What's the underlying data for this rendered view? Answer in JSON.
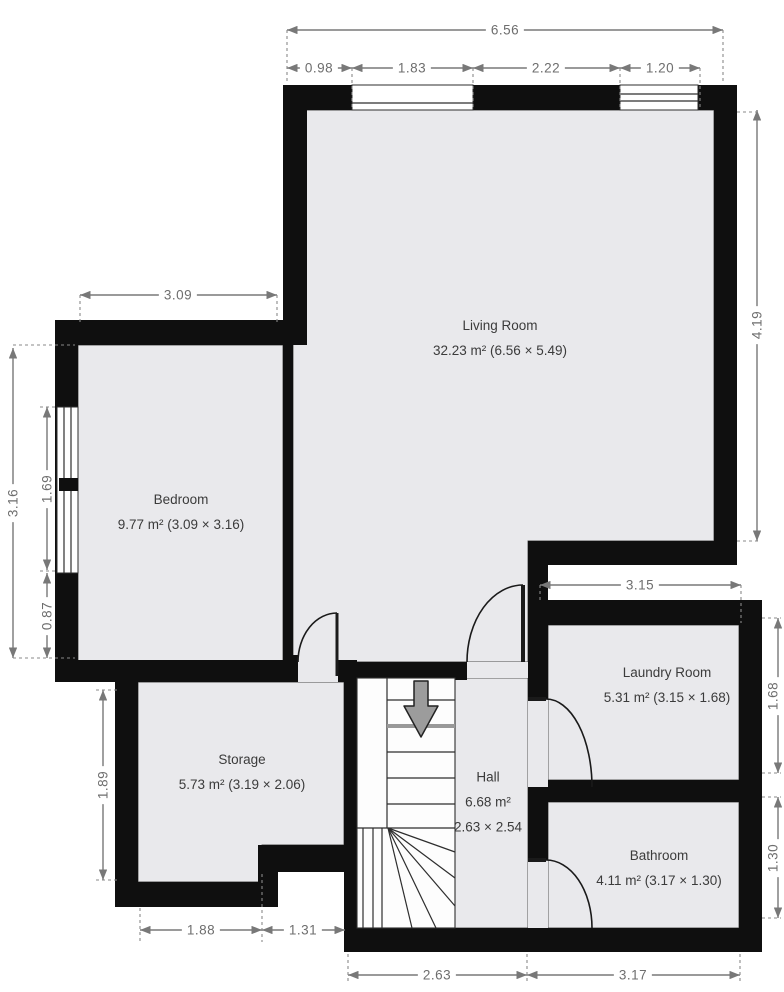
{
  "title": "Floor plan",
  "rooms": {
    "living": {
      "name": "Living Room",
      "area": "32.23 m² (6.56 × 5.49)"
    },
    "bedroom": {
      "name": "Bedroom",
      "area": "9.77 m² (3.09 × 3.16)"
    },
    "storage": {
      "name": "Storage",
      "area": "5.73 m² (3.19 × 2.06)"
    },
    "hall": {
      "name": "Hall",
      "area": "6.68 m²",
      "size": "2.63 × 2.54"
    },
    "laundry": {
      "name": "Laundry Room",
      "area": "5.31 m² (3.15 × 1.68)"
    },
    "bathroom": {
      "name": "Bathroom",
      "area": "4.11 m² (3.17 × 1.30)"
    }
  },
  "dimensions": {
    "top_total": "6.56",
    "top_seg1": "0.98",
    "top_seg2": "1.83",
    "top_seg3": "2.22",
    "top_seg4": "1.20",
    "bedroom_width": "3.09",
    "bedroom_height": "3.16",
    "window_left": "1.69",
    "below_window": "0.87",
    "storage_left": "1.89",
    "living_right": "4.19",
    "laundry_width": "3.15",
    "laundry_right": "1.68",
    "bathroom_right": "1.30",
    "bottom_storage": "1.88",
    "bottom_step": "1.31",
    "bottom_hall": "2.63",
    "bottom_laundry": "3.17"
  },
  "icons": {
    "stairs_direction": "down-arrow"
  },
  "colors": {
    "wall": "#0f0f0f",
    "floor": "#e9e9ec",
    "dimension": "#787878",
    "label_text": "#3b3b3b",
    "stairs_arrow": "#9c9c9c"
  }
}
